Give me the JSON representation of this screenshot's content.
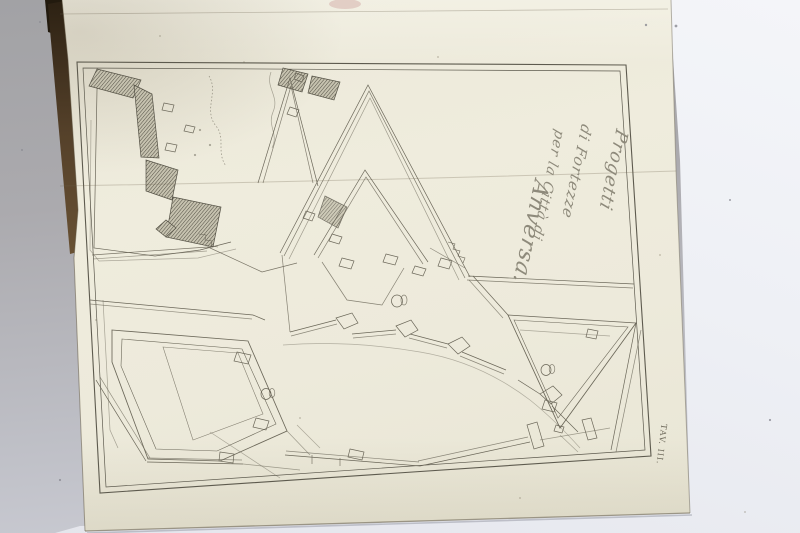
{
  "photo": {
    "description": "Photograph of an antique bound volume opened to an engraved fortification plate, drawing rotated 90 degrees on the page",
    "colors": {
      "table_surface": "#a9a9ad",
      "underlying_page": "#eef0f5",
      "plate_page": "#ece9da",
      "book_fore_edge": "#6e5636",
      "engraving_ink": "#6b6759",
      "script_ink": "#8e8a7b"
    }
  },
  "plate": {
    "title_lines": [
      "Progetti",
      "di Fortezze",
      "per la Città di",
      "Anversa."
    ],
    "plate_label": "TAV. III."
  }
}
